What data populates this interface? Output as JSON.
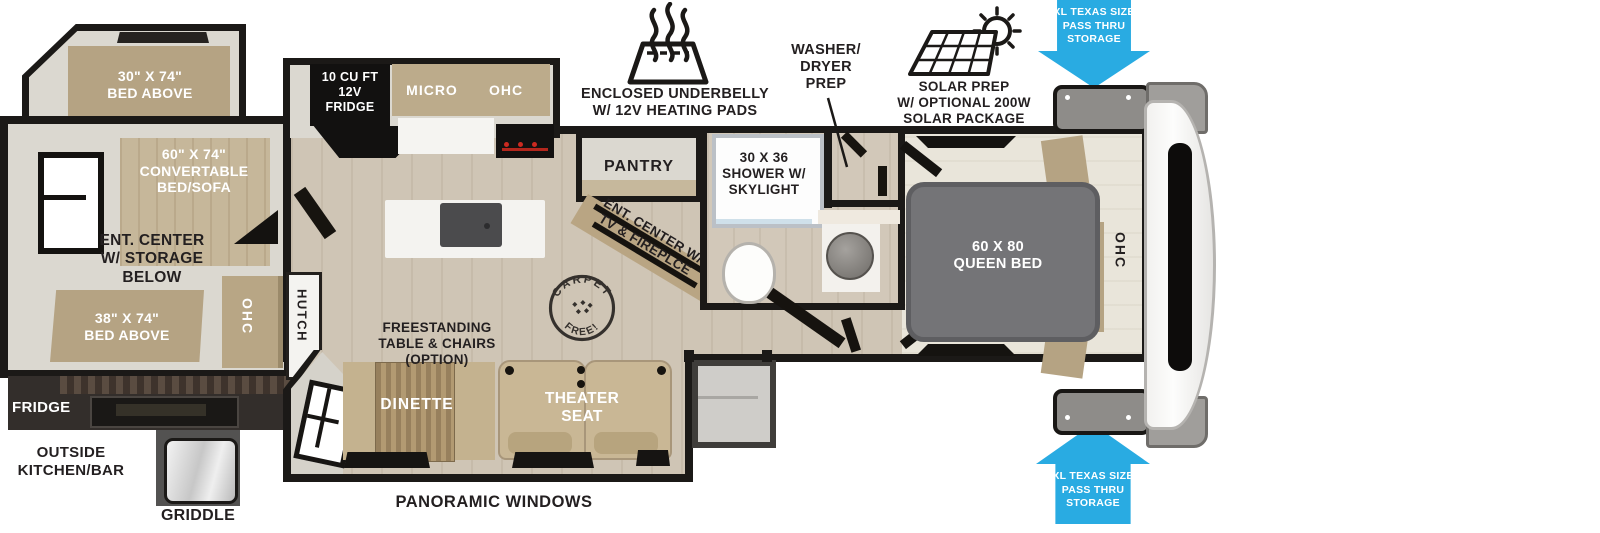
{
  "colors": {
    "accent_blue": "#29abe2",
    "wall_black": "#1b1917",
    "furniture_tan": "#b5a383",
    "floor_wood": "#cfc5b5",
    "queen_gray": "#747477"
  },
  "exterior": {
    "underbelly_label": "ENCLOSED UNDERBELLY\nW/ 12V HEATING PADS",
    "washer_dryer_label": "WASHER/\nDRYER\nPREP",
    "solar_label": "SOLAR PREP\nW/ OPTIONAL 200W\nSOLAR PACKAGE",
    "pass_thru_top": "XL TEXAS SIZE\nPASS THRU\nSTORAGE",
    "pass_thru_bottom": "XL TEXAS SIZE\nPASS THRU\nSTORAGE",
    "panoramic_label": "PANORAMIC WINDOWS",
    "outside_kitchen_label": "OUTSIDE\nKITCHEN/BAR",
    "outside_fridge_label": "FRIDGE",
    "griddle_label": "GRIDDLE"
  },
  "bunk_room": {
    "bed_30": "30\" X 74\"\nBED ABOVE",
    "bed_60": "60\" X 74\"\nCONVERTABLE\nBED/SOFA",
    "ent_center": "ENT. CENTER\nW/ STORAGE\nBELOW",
    "bed_38": "38\" X 74\"\nBED ABOVE",
    "ohc": "OHC",
    "hutch": "HUTCH"
  },
  "kitchen": {
    "fridge": "10 CU FT\n12V\nFRIDGE",
    "micro": "MICRO",
    "ohc": "OHC",
    "pantry": "PANTRY"
  },
  "living": {
    "freestanding": "FREESTANDING\nTABLE & CHAIRS\n(OPTION)",
    "dinette": "DINETTE",
    "theater": "THEATER\nSEAT",
    "ent_center_tv": "ENT. CENTER W/\nTV & FIREPLCE",
    "carpet_free_top": "CARPET",
    "carpet_free_bottom": "FREE!"
  },
  "bathroom": {
    "shower": "30 X 36\nSHOWER W/\nSKYLIGHT"
  },
  "bedroom": {
    "queen_bed": "60 X 80\nQUEEN BED",
    "ohc": "OHC"
  }
}
